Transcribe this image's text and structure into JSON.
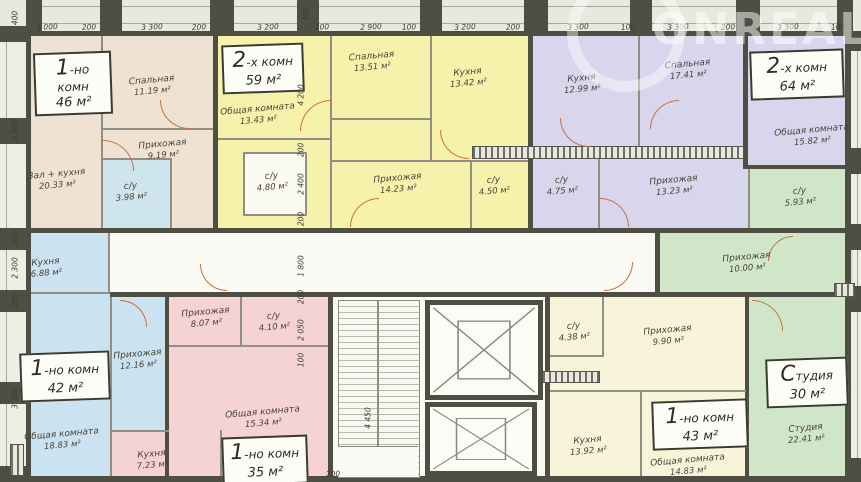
{
  "plan": {
    "title": "floor-plan",
    "watermark": "ONREALT",
    "palette": {
      "wall": "#4e4e43",
      "partition": "#8f8f83",
      "apt46": "#f0e2d2",
      "apt59": "#f6f2ab",
      "apt64": "#d8d6ed",
      "apt42": "#cbe2f0",
      "apt35": "#f6d3d3",
      "apt43": "#f8f4d9",
      "studio30": "#cfe7c8",
      "bathroom_blue": "#cfe5ee",
      "corridor": "#fbfaf5",
      "door_arc": "#c9713f"
    },
    "apartments": [
      {
        "id": "apt-46",
        "type_label": "1-но комн",
        "area_label": "46 м²",
        "rooms": [
          {
            "name": "Спальная",
            "area": "11.19 м²"
          },
          {
            "name": "Прихожая",
            "area": "9.19 м²"
          },
          {
            "name": "Зал + кухня",
            "area": "20.33 м²"
          },
          {
            "name": "с/у",
            "area": "3.98 м²"
          }
        ]
      },
      {
        "id": "apt-59",
        "type_label": "2-х комн",
        "area_label": "59 м²",
        "rooms": [
          {
            "name": "Общая комната",
            "area": "13.43 м²"
          },
          {
            "name": "Спальная",
            "area": "13.51 м²"
          },
          {
            "name": "Кухня",
            "area": "13.42 м²"
          },
          {
            "name": "с/у",
            "area": "4.80 м²"
          },
          {
            "name": "Прихожая",
            "area": "14.23 м²"
          },
          {
            "name": "с/у",
            "area": "4.50 м²"
          }
        ]
      },
      {
        "id": "apt-64",
        "type_label": "2-х комн",
        "area_label": "64 м²",
        "rooms": [
          {
            "name": "Кухня",
            "area": "12.99 м²"
          },
          {
            "name": "Спальная",
            "area": "17.41 м²"
          },
          {
            "name": "Общая комната",
            "area": "15.82 м²"
          },
          {
            "name": "с/у",
            "area": "4.75 м²"
          },
          {
            "name": "Прихожая",
            "area": "13.23 м²"
          }
        ]
      },
      {
        "id": "apt-42",
        "type_label": "1-но комн",
        "area_label": "42 м²",
        "rooms": [
          {
            "name": "Кухня",
            "area": "6.88 м²"
          },
          {
            "name": "Прихожая",
            "area": "12.16 м²"
          },
          {
            "name": "Общая комната",
            "area": "18.83 м²"
          }
        ]
      },
      {
        "id": "apt-35",
        "type_label": "1-но комн",
        "area_label": "35 м²",
        "rooms": [
          {
            "name": "Прихожая",
            "area": "8.07 м²"
          },
          {
            "name": "с/у",
            "area": "4.10 м²"
          },
          {
            "name": "Общая комната",
            "area": "15.34 м²"
          },
          {
            "name": "Кухня",
            "area": "7.23 м²"
          }
        ]
      },
      {
        "id": "apt-43",
        "type_label": "1-но комн",
        "area_label": "43 м²",
        "rooms": [
          {
            "name": "с/у",
            "area": "4.38 м²"
          },
          {
            "name": "Прихожая",
            "area": "9.90 м²"
          },
          {
            "name": "Кухня",
            "area": "13.92 м²"
          },
          {
            "name": "Общая комната",
            "area": "14.83 м²"
          }
        ]
      },
      {
        "id": "studio-30",
        "type_label": "Студия",
        "area_label": "30 м²",
        "rooms": [
          {
            "name": "Прихожая",
            "area": "10.00 м²"
          },
          {
            "name": "с/у",
            "area": "5.93 м²"
          },
          {
            "name": "Студия",
            "area": "22.41 м²"
          }
        ]
      }
    ],
    "dimensions": {
      "top": [
        "3 000",
        "200",
        "3 300",
        "200",
        "3 200",
        "200",
        "2 900",
        "100",
        "3 200",
        "200",
        "3 300",
        "100",
        "3 300",
        "200",
        "3 300",
        "100"
      ],
      "left": [
        "400",
        "6 800",
        "200",
        "2 300",
        "200",
        "3 300"
      ],
      "inner": [
        "4 200",
        "200",
        "2 400",
        "200",
        "1 800",
        "200",
        "2 050",
        "100"
      ],
      "misc": [
        "400",
        "4 450",
        "200"
      ]
    }
  }
}
